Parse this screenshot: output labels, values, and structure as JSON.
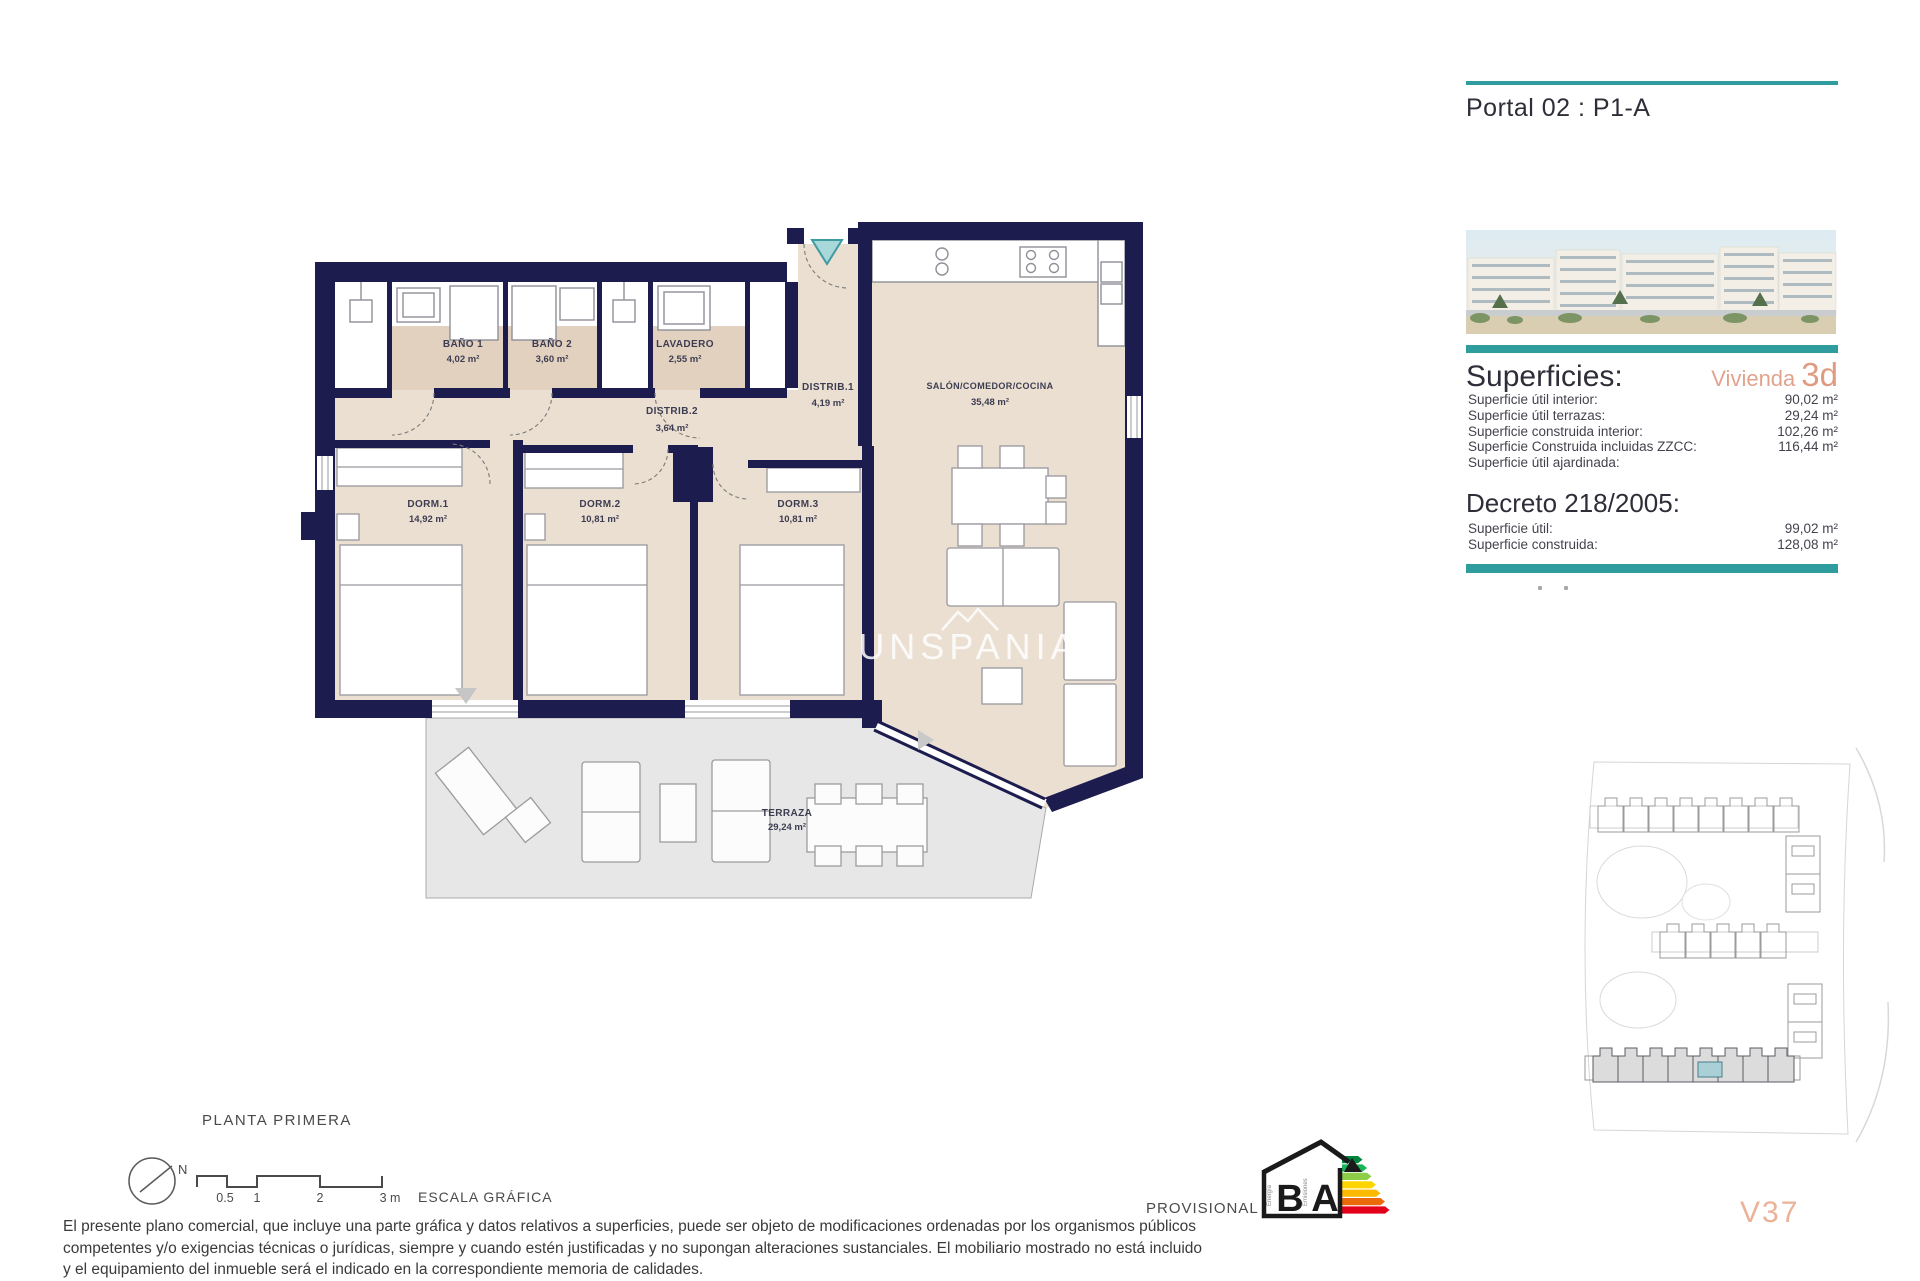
{
  "header": {
    "portal_title": "Portal 02 : P1-A"
  },
  "plan": {
    "floor_title": "PLANTA PRIMERA",
    "watermark": "UNSPANIA",
    "north_label": "N",
    "scale": {
      "tick1": "0.5",
      "tick2": "1",
      "tick3": "2",
      "tick4": "3 m",
      "caption": "ESCALA GRÁFICA"
    },
    "rooms": [
      {
        "name": "BAÑO 1",
        "area": "4,02 m²"
      },
      {
        "name": "BAÑO 2",
        "area": "3,60 m²"
      },
      {
        "name": "LAVADERO",
        "area": "2,55 m²"
      },
      {
        "name": "DISTRIB.1",
        "area": "4,19 m²"
      },
      {
        "name": "DISTRIB.2",
        "area": "3,64 m²"
      },
      {
        "name": "SALÓN/COMEDOR/COCINA",
        "area": "35,48 m²"
      },
      {
        "name": "DORM.1",
        "area": "14,92 m²"
      },
      {
        "name": "DORM.2",
        "area": "10,81 m²"
      },
      {
        "name": "DORM.3",
        "area": "10,81 m²"
      },
      {
        "name": "TERRAZA",
        "area": "29,24 m²"
      }
    ]
  },
  "sidebar": {
    "superficies": {
      "heading": "Superficies:",
      "vivienda_label": "Vivienda",
      "vivienda_value": "3d",
      "rows": [
        {
          "label": "Superficie útil interior:",
          "value": "90,02 m²"
        },
        {
          "label": "Superficie útil terrazas:",
          "value": "29,24 m²"
        },
        {
          "label": "Superficie construida interior:",
          "value": "102,26 m²"
        },
        {
          "label": "Superficie Construida incluidas ZZCC:",
          "value": "116,44 m²"
        },
        {
          "label": "Superficie útil ajardinada:",
          "value": ""
        }
      ]
    },
    "decreto": {
      "heading": "Decreto 218/2005:",
      "rows": [
        {
          "label": "Superficie útil:",
          "value": "99,02 m²"
        },
        {
          "label": "Superficie construida:",
          "value": "128,08 m²"
        }
      ]
    },
    "unit_code": "V37"
  },
  "footer": {
    "provisional": "PROVISIONAL",
    "energy": {
      "letter_left": "B",
      "letter_right": "A",
      "caption_left": "Energía",
      "caption_right": "Emisiones"
    },
    "disclaimer_lines": [
      "El presente plano comercial, que incluye una parte gráfica y datos relativos a superficies, puede ser objeto de modificaciones ordenadas por los organismos públicos",
      "competentes y/o exigencias técnicas o jurídicas, siempre y cuando estén justificadas y no supongan alteraciones sustanciales. El mobiliario mostrado no está incluido",
      "y el equipamiento del inmueble será el indicado en la correspondiente memoria de calidades."
    ]
  },
  "colors": {
    "accent_teal": "#2f9c9e",
    "accent_salmon": "#df9b80",
    "wall_navy": "#1c1c4f",
    "site_highlight": "#aacfd6"
  }
}
